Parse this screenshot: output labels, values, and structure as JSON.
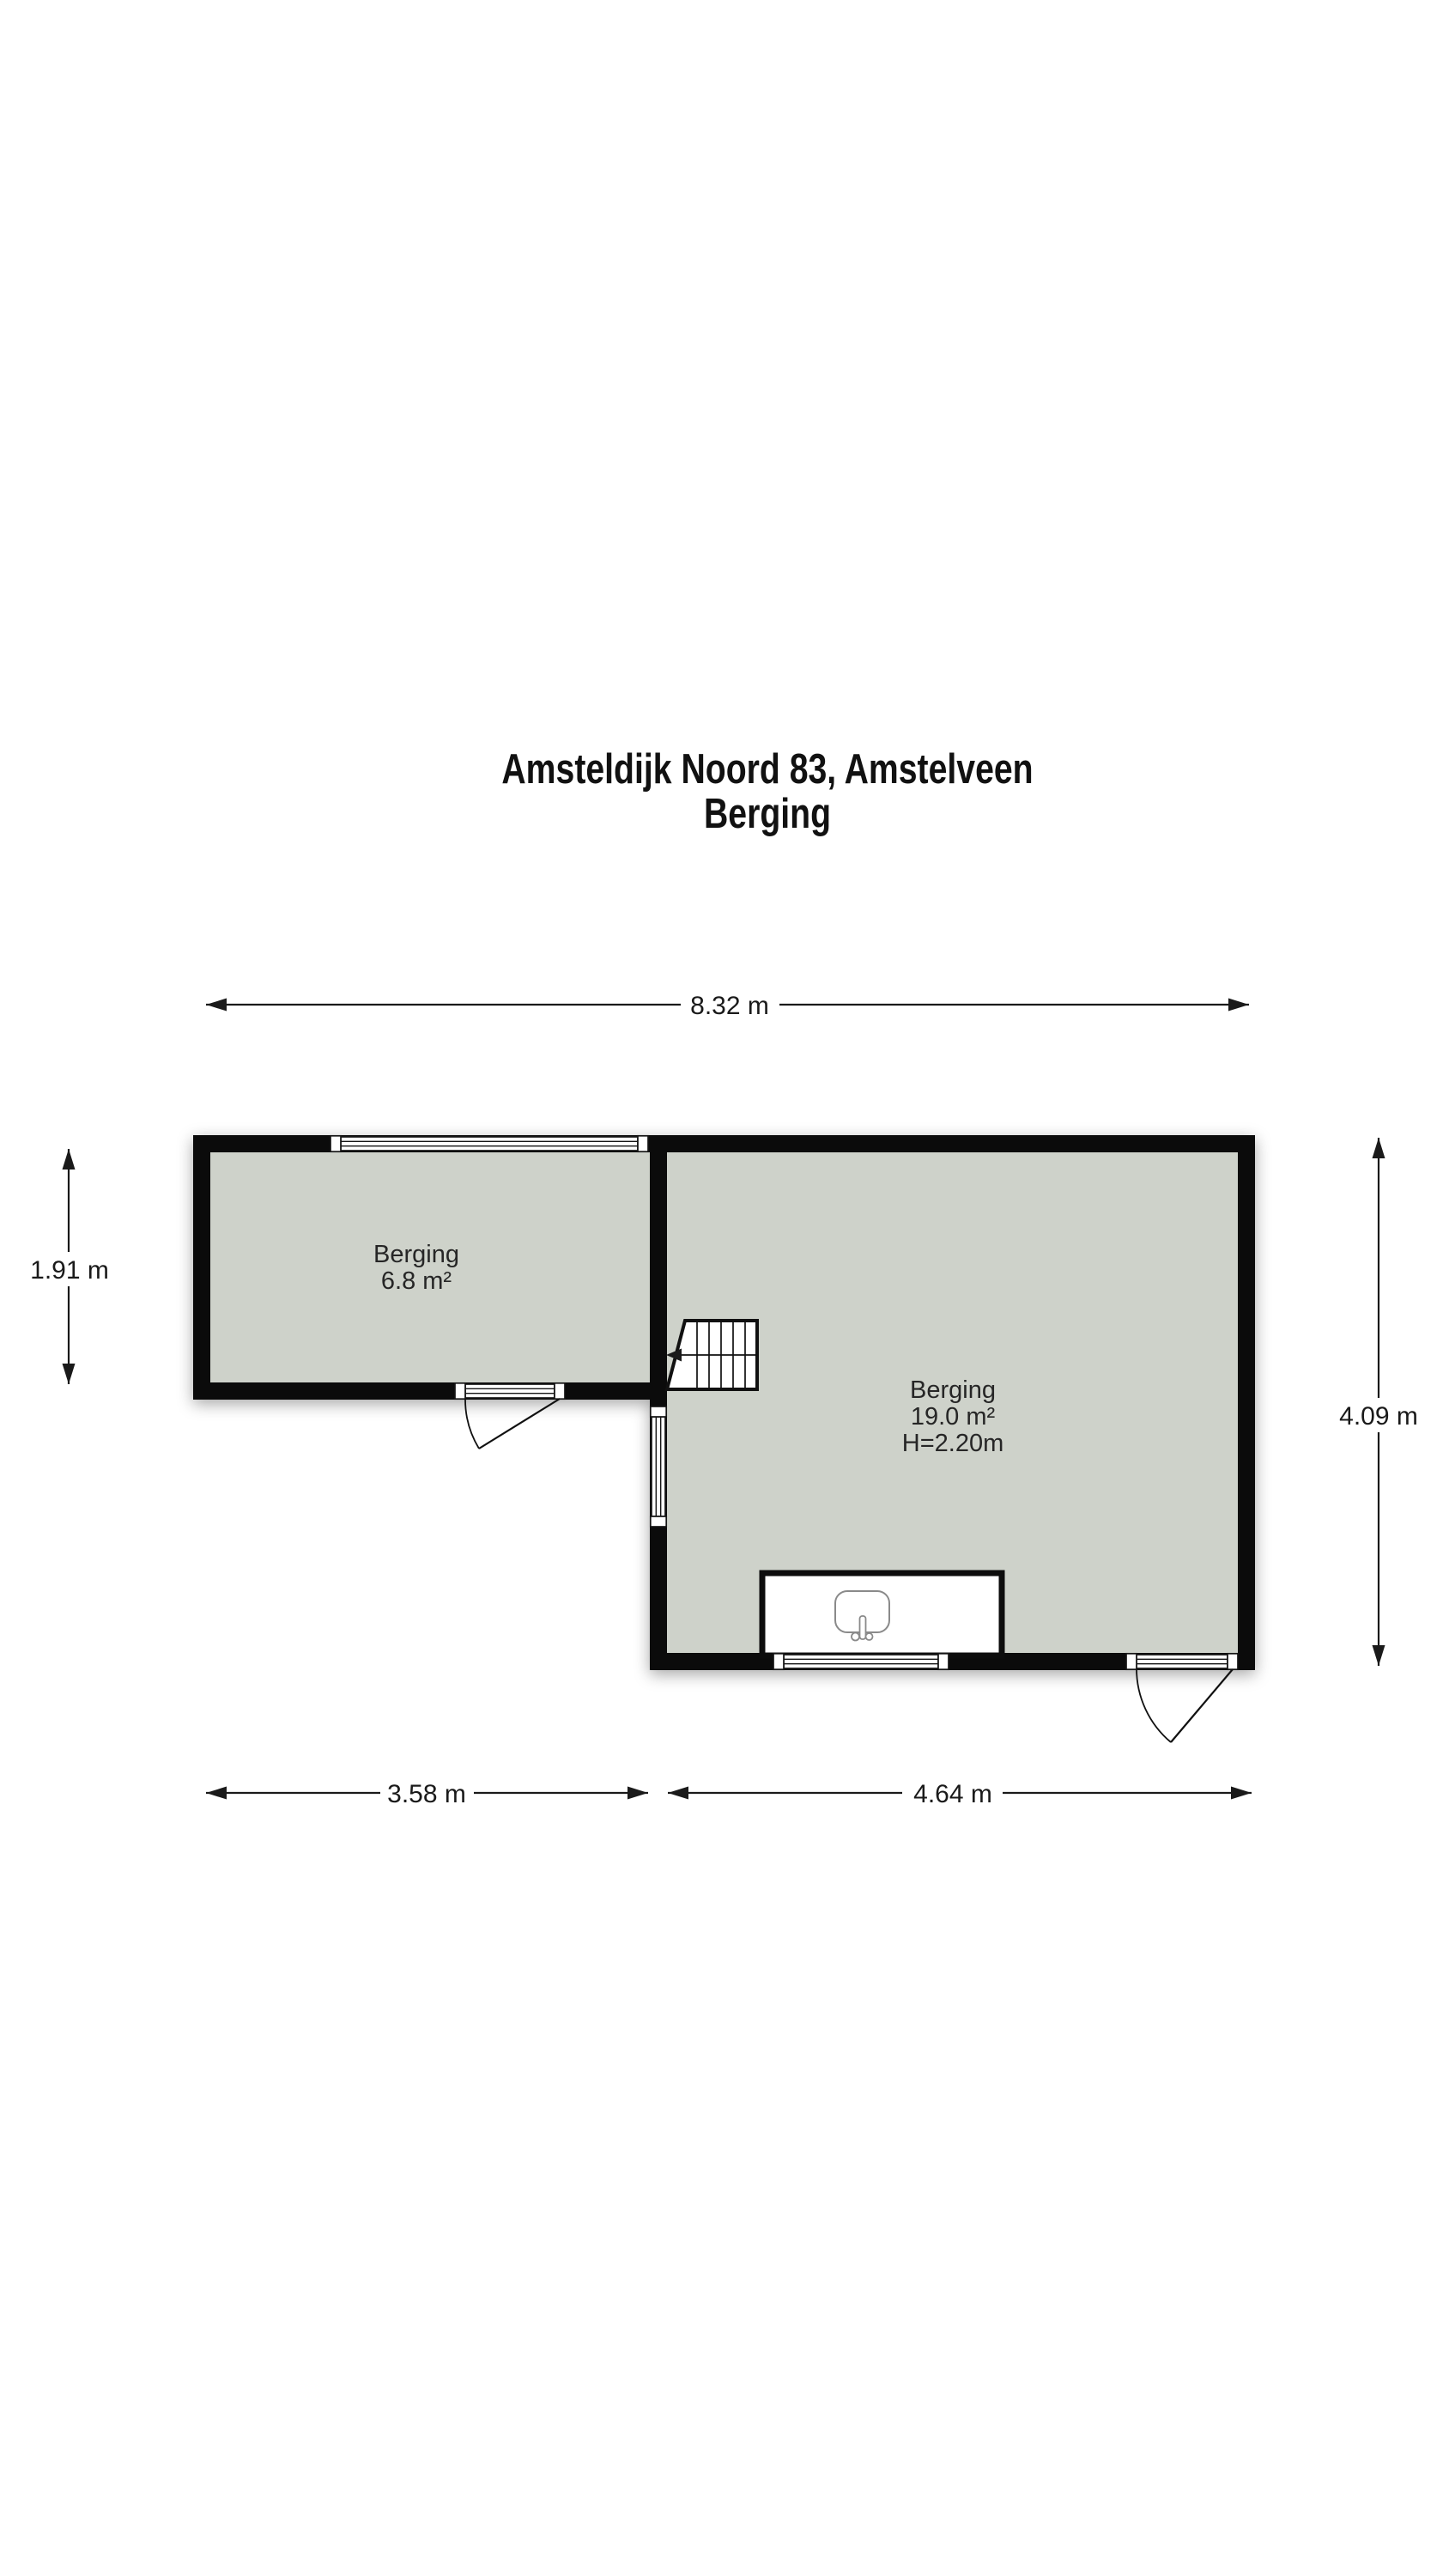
{
  "title": {
    "line1": "Amsteldijk Noord 83, Amstelveen",
    "line2": "Berging"
  },
  "dimensions": {
    "top_width": "8.32 m",
    "bottom_left_width": "3.58 m",
    "bottom_right_width": "4.64 m",
    "left_height": "1.91 m",
    "right_height": "4.09 m"
  },
  "rooms": [
    {
      "name": "Berging",
      "area": "6.8 m²"
    },
    {
      "name": "Berging",
      "area": "19.0 m²",
      "ceiling_height": "H=2.20m"
    }
  ],
  "symbols": {
    "staircase": "stairs-with-direction-arrow",
    "sink": "sink-with-tap",
    "doors": "swing-arc-doors",
    "windows": "triple-line-glazing"
  },
  "colors": {
    "wall": "#0b0b0b",
    "floor": "#ced2ca",
    "background": "#ffffff",
    "dimension_text": "#1a1a1a"
  }
}
